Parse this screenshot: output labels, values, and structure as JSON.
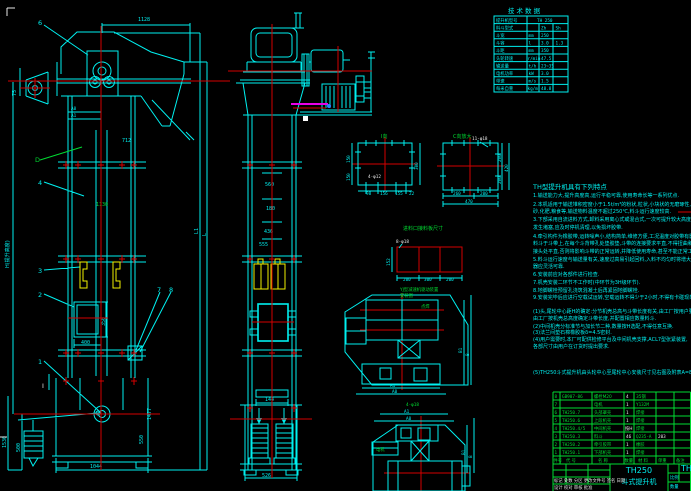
{
  "colors": {
    "cyan": "#00f0f0",
    "green": "#00dc32",
    "red": "#d40000",
    "yellow": "#f0f000",
    "magenta": "#e800e8",
    "white": "#e8e8e8"
  },
  "front": {
    "c6": "6",
    "c4": "4",
    "c3": "3",
    "c2": "2",
    "c1": "1",
    "c7": "7",
    "c8": "8",
    "dim_top": "1128",
    "dim_chute": "712",
    "dim_75": "75",
    "dim_h": "H(提升高度)",
    "dim_1130": "1130",
    "a0": "A0",
    "a1": "A1",
    "d": "D",
    "sec_i": "I",
    "dim_400": "400",
    "dim_350": "350",
    "dim_1044": "1044",
    "dim_1530": "1530",
    "dim_500": "500",
    "dim_1477": "1477",
    "dim_550": "550",
    "l1": "L1",
    "l": "L"
  },
  "side": {
    "d560": "560",
    "d180": "180",
    "d436": "436",
    "d555": "555",
    "d144": "144",
    "d526": "526"
  },
  "spec": {
    "title": "技 术 数 据",
    "rows": [
      [
        "提升机型号",
        "",
        "TH 250",
        ""
      ],
      [
        "料斗型式",
        "",
        "Zh",
        "Sh"
      ],
      [
        "斗宽",
        "mm",
        "250",
        ""
      ],
      [
        "斗容",
        "l",
        "3.0",
        "1.3"
      ],
      [
        "斗距",
        "mm",
        "350",
        ""
      ],
      [
        "头轮转速",
        "r/min",
        "47.5",
        ""
      ],
      [
        "输送量",
        "t/h",
        "23~35",
        ""
      ],
      [
        "电机功率",
        "kW",
        "3.0",
        ""
      ],
      [
        "带速",
        "m/s",
        "1.5",
        ""
      ],
      [
        "每米自重",
        "kg/m",
        "48.8",
        ""
      ]
    ]
  },
  "features": {
    "title": "TH型提升机具有下列特点",
    "lines": [
      "1.输送能力大,提升高度高,运行平稳可靠,使用寿命长等一系列优点.",
      "2.本机适用于输送堆积密度小于1.5t/m³的粉状,粒状,小块状的无磨琢性,半磨琢性物料,如煤,水泥,碎石,",
      "  砂,化肥,粮食等,输送物料温度不超过250℃,料斗运行速度较高.",
      "3.下部采用自流进料方式,卸料采用离心式或混合式,一次可提升较大高度,动力消耗小,万一",
      "  发生堵塞,应及时停机清理,以免损坏胶带.",
      "4.牵引构件为橡胶带,运转噪声小,结构简单,维修方便,工况温度对胶带有影响,安装",
      "  料斗于斗带上,在每个斗背带孔处垫胶垫,斗带的连接要求平直,不得扭曲和起鼓,",
      "  接头处平直,否则将影响斗带的正常运转,并降低使用寿命,甚至不能正常工作.",
      "5.料斗运行速度与输送量有关,速度过高易引起回料,入料不均匀时将增大功率消耗,逆止",
      "  器应灵活可靠.",
      "6.安装前应对各部件进行检查.",
      "7.机壳安装二环节不工作时(中环节为3H级环节).",
      "8.地脚螺栓预留孔浇筑混凝土后再紧固地脚螺栓.",
      "9.安装完毕后应进行空载试运转,空载运转不得少于2小时,不得有卡碰现象,轴承温升不超过25℃.",
      "(1)头,尾轮中心距H的确定:分节机壳总高与斗带长度有关,由工厂按用户要求配置,",
      "  由工厂按机壳总高度确定斗带长度,并配置相应数量料斗.",
      "(2)中间机壳分标准节与加长节二种,数量按H选配,不得任意互换.",
      "(3)法兰间垫石棉橡胶板δ=4.5密封.",
      "(4)用户需要时,本厂可配供检修平台及中间机壳支撑,ACL7型张紧装置,",
      "  各部尺寸由用户在订货时提出要求.",
      "(5)TH250斗式提升机由头轮中心至尾轮中心安装尺寸见右图及附表A=840."
    ]
  },
  "details": {
    "i": {
      "label": "I向",
      "note": "4-φ12",
      "l1": "150",
      "l2": "150",
      "r": "300",
      "b1": "98",
      "b2": "156",
      "b3": "155",
      "b4": "22"
    },
    "c": {
      "label": "C向放大",
      "note": "11-φ18",
      "r1": "200",
      "r2": "200",
      "r3": "420",
      "b1": "260",
      "b2": "200",
      "b3": "470"
    },
    "feed": {
      "title": "进料口接料板尺寸",
      "note": "8-φ18",
      "left": "152",
      "b1": "200",
      "b2": "300",
      "b3": "200"
    },
    "dt": {
      "t1": "YJ型减速机驱动装置",
      "t2": "安装图",
      "weld": "点焊",
      "a1": "A1",
      "a0": "A0",
      "b1": "B1",
      "b": "B"
    },
    "db": {
      "a1": "A1",
      "a0": "A0",
      "motor": "电机",
      "hole": "4-φ18",
      "b1": "B1",
      "b": "B"
    }
  },
  "bom": {
    "headers": [
      "件号",
      "代 号",
      "名 称",
      "数量",
      "材 料",
      "单重",
      "备注"
    ],
    "rows": [
      {
        "no": "8",
        "code": "GB907-86",
        "name": "螺栓M20",
        "qty": "4",
        "mat": "35钢",
        "wt": ""
      },
      {
        "no": "7",
        "code": "",
        "name": "电机",
        "qty": "1",
        "mat": "Y132M",
        "wt": ""
      },
      {
        "no": "6",
        "code": "TH250.7",
        "name": "头部罩壳",
        "qty": "1",
        "mat": "焊接",
        "wt": ""
      },
      {
        "no": "5",
        "code": "TH250.6",
        "name": "上段机壳",
        "qty": "1",
        "mat": "焊接",
        "wt": ""
      },
      {
        "no": "4",
        "code": "TH250.4/5",
        "name": "中间机壳",
        "qty": "按H",
        "mat": "焊接",
        "wt": ""
      },
      {
        "no": "3",
        "code": "TH250.3",
        "name": "料斗",
        "qty": "46",
        "mat": "Q235-A",
        "wt": "203"
      },
      {
        "no": "2",
        "code": "TH250.2",
        "name": "牵引胶带",
        "qty": "1",
        "mat": "橡胶",
        "wt": ""
      },
      {
        "no": "1",
        "code": "TH250.1",
        "name": "下部机壳",
        "qty": "1",
        "mat": "焊接",
        "wt": ""
      }
    ]
  },
  "title_block": {
    "model": "TH250",
    "product": "斗式提升机",
    "model_right": "TH250",
    "scale": "比例",
    "qty": "数量",
    "rev": "标记 处数 分区 更改文件号 签名 日期",
    "sign": "设计  校对  审核  批准"
  }
}
